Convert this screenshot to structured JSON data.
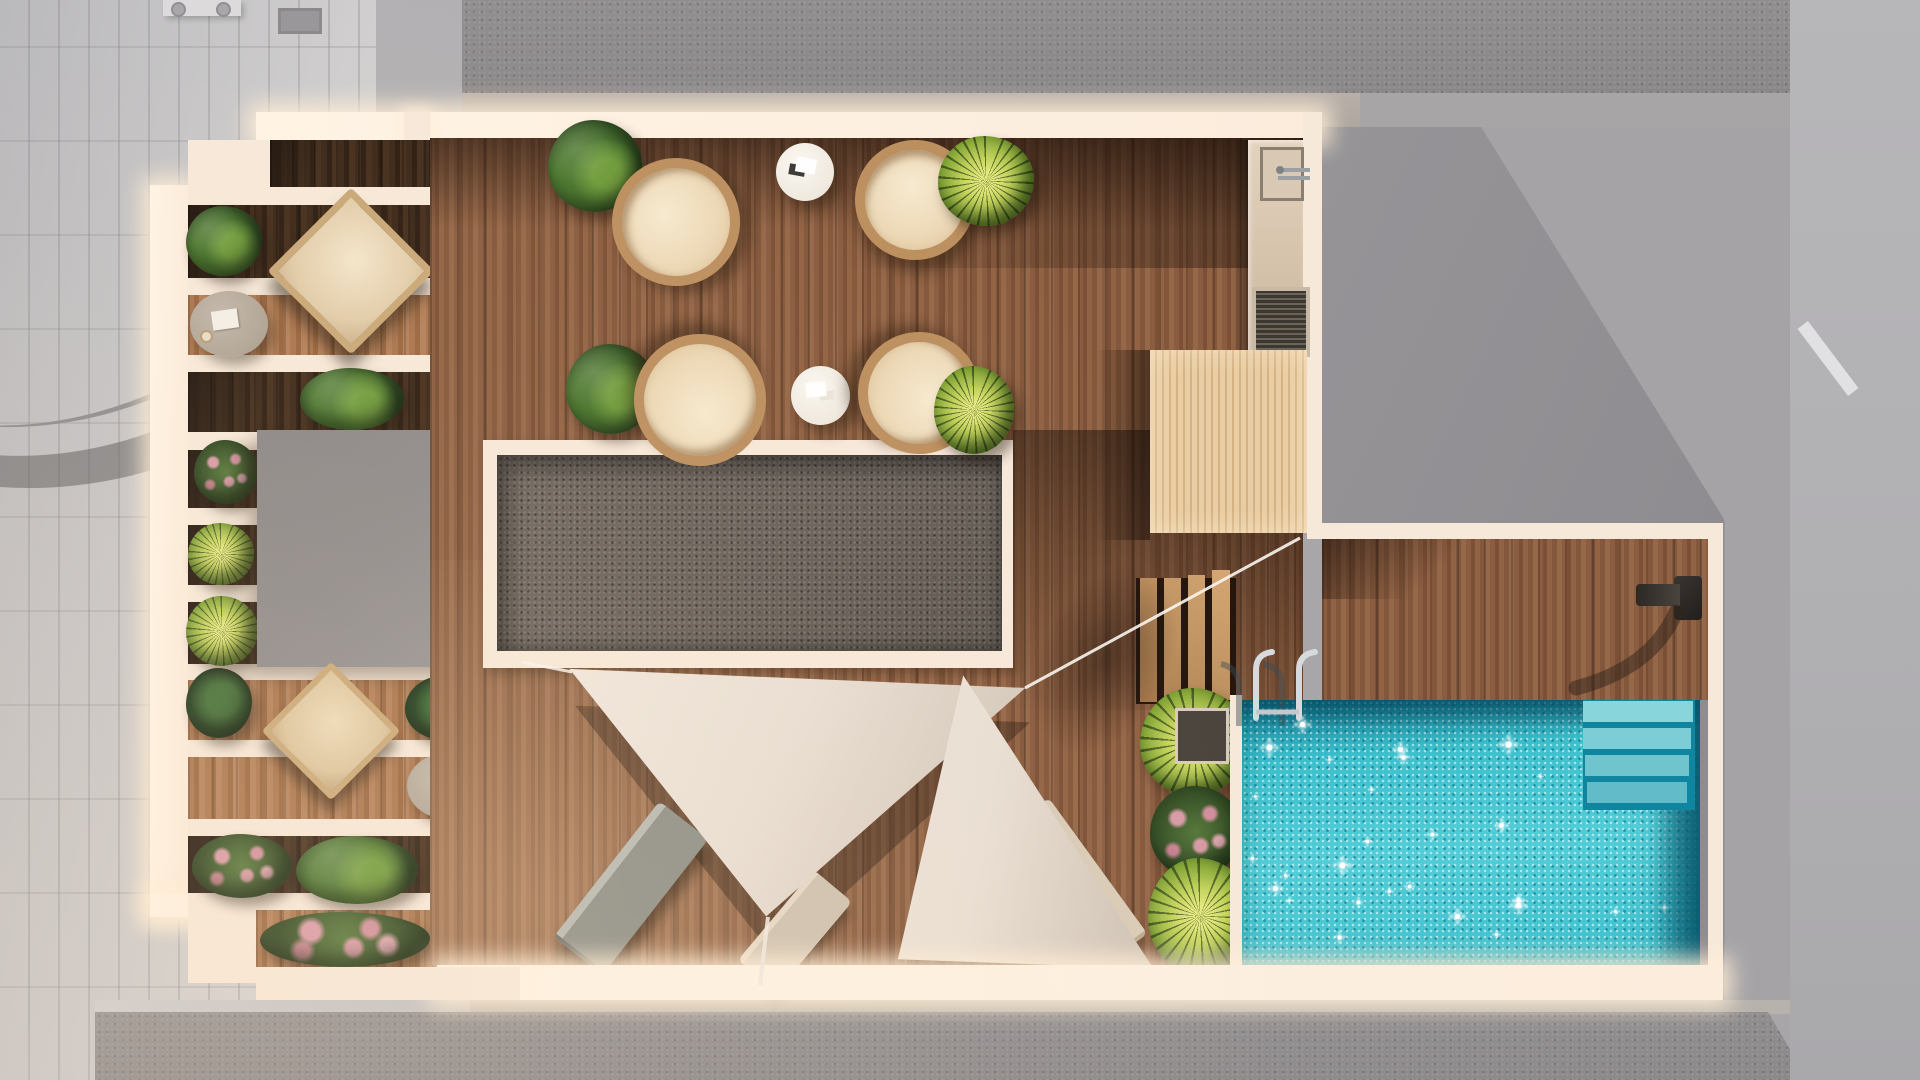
{
  "scene": {
    "title": "Rooftop terrace floor plan - aerial 3D architectural render",
    "type": "architectural-render",
    "view": "top-down"
  },
  "palette": {
    "bg": "#a8a6a9",
    "pavement": "#c9c8ca",
    "roof-texture": "#918e90",
    "parapet": "#b3aba4",
    "cream": "#f7e9da",
    "cream-bright": "#fff4e6",
    "wood-deck": "#8a5c40",
    "wood-dark": "#33211a",
    "wood-lit": "#a9754e",
    "pergola-wood": "#e9cda4",
    "gravel": "#675f59",
    "gray-block": "#8e8b8c",
    "pool-water": "#3cc0cd",
    "pool-deep": "#15879d",
    "pool-step": "#8fd9de",
    "sail": "#e9dfd4",
    "sail-shade": "#cbbfb2",
    "lounger-gray": "#8f9189",
    "lounger-beige": "#d9cbb8",
    "plant-dark": "#25401c",
    "plant-mid": "#4a772e",
    "plant-light": "#6f9c3c",
    "palm-yellow": "#c3d35c",
    "chrome": "#d6dadd",
    "counter": "#dac9b6",
    "shadow": "#3a2a1d"
  },
  "areas": {
    "left_balcony": {
      "label": "Pergola balcony with planter rows"
    },
    "dining_terrace": {
      "label": "Dining terrace with rattan chairs"
    },
    "gravel_roof": {
      "label": "Gravel roof section"
    },
    "bulkhead": {
      "label": "Stair / elevator bulkhead roof"
    },
    "outdoor_kitchen": {
      "label": "Outdoor kitchenette with sink"
    },
    "pergola_deck": {
      "label": "Slatted timber pergola deck"
    },
    "stairs": {
      "label": "Deck steps to pool level",
      "treads": 4
    },
    "pool_deck": {
      "label": "Pool deck with outdoor shower"
    },
    "pool": {
      "label": "Swimming pool",
      "underwater_steps": 4,
      "sparkle_count": 30,
      "sparkle_seed": 7
    },
    "lounge_area": {
      "label": "Shade-sail lounge area"
    },
    "planter_bed": {
      "label": "Poolside planter bed"
    },
    "surroundings": {
      "label": "Neighbouring rooftops and street paving"
    }
  },
  "objects": [
    {
      "name": "rattan-lounge-chair",
      "label": "Round rattan lounge chair",
      "count": 4
    },
    {
      "name": "bistro-table",
      "label": "Round white bistro table",
      "count": 2
    },
    {
      "name": "gray-side-table",
      "label": "Round side table with book and cup",
      "count": 2
    },
    {
      "name": "deck-recliner",
      "label": "Wooden recliner with cushion",
      "count": 1
    },
    {
      "name": "wood-armchair",
      "label": "Wooden armchair with cushion",
      "count": 1
    },
    {
      "name": "sun-lounger",
      "label": "Sun lounger",
      "count": 3
    },
    {
      "name": "shade-sail",
      "label": "Triangular shade sail",
      "count": 2
    },
    {
      "name": "pool-ladder",
      "label": "Chrome pool ladder",
      "count": 1
    },
    {
      "name": "outdoor-shower",
      "label": "Wall-mounted outdoor shower",
      "count": 1
    },
    {
      "name": "sink",
      "label": "Kitchenette sink with faucet",
      "count": 1
    },
    {
      "name": "vent-grate",
      "label": "Slatted vent grate",
      "count": 1
    },
    {
      "name": "roof-vent",
      "label": "Roof vent pipe",
      "count": 2
    },
    {
      "name": "planter",
      "label": "Planter with shrubs, palms and roses",
      "count": 14
    }
  ]
}
